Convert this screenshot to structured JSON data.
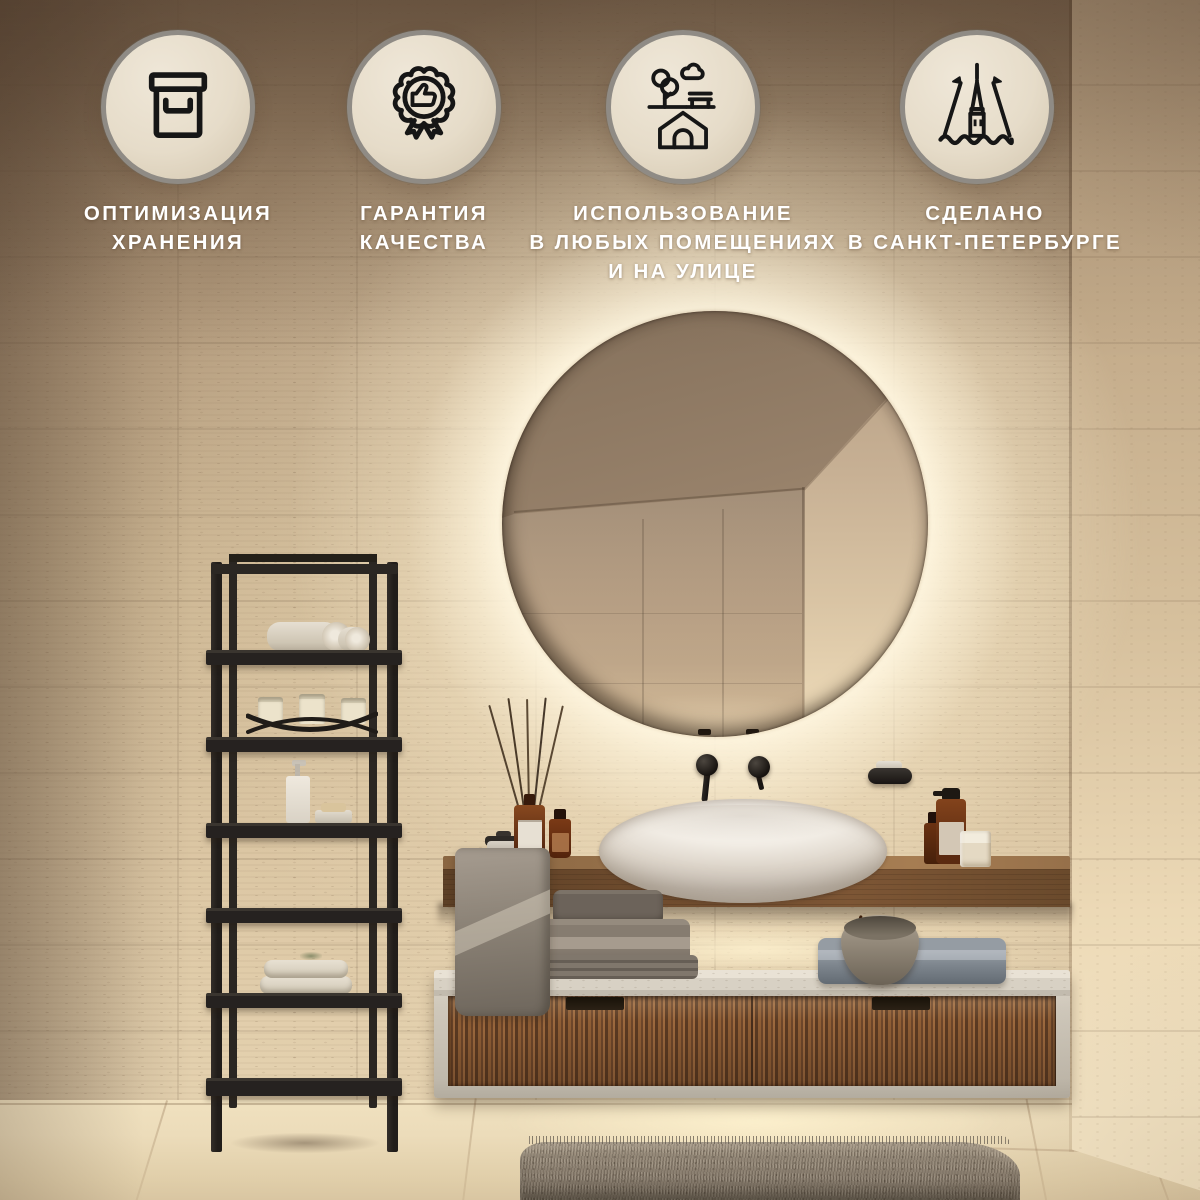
{
  "badges": [
    {
      "icon": "storage-box-icon",
      "lines": [
        "ОПТИМИЗАЦИЯ",
        "ХРАНЕНИЯ"
      ]
    },
    {
      "icon": "quality-medal-icon",
      "lines": [
        "ГАРАНТИЯ",
        "КАЧЕСТВА"
      ]
    },
    {
      "icon": "indoor-outdoor-icon",
      "lines": [
        "ИСПОЛЬЗОВАНИЕ",
        "В ЛЮБЫХ ПОМЕЩЕНИЯХ",
        "И НА УЛИЦЕ"
      ]
    },
    {
      "icon": "saint-petersburg-spire-icon",
      "lines": [
        "СДЕЛАНО",
        "В САНКТ-ПЕТЕРБУРГЕ"
      ]
    }
  ],
  "colors": {
    "badge_fill": "#e7ddca",
    "badge_ring": "#8f8b85",
    "icon_ink": "#161616",
    "caption_text": "#ffffff",
    "backlight_glow": "#f8eed6",
    "wall_travertine": "#c8b394",
    "counter_wood": "#6b4a2d",
    "cabinet_stone": "#d2cbbe",
    "fluted_wood": "#7b4f2e",
    "towel_gray": "#8a8075",
    "shelf_charcoal": "#282420"
  }
}
